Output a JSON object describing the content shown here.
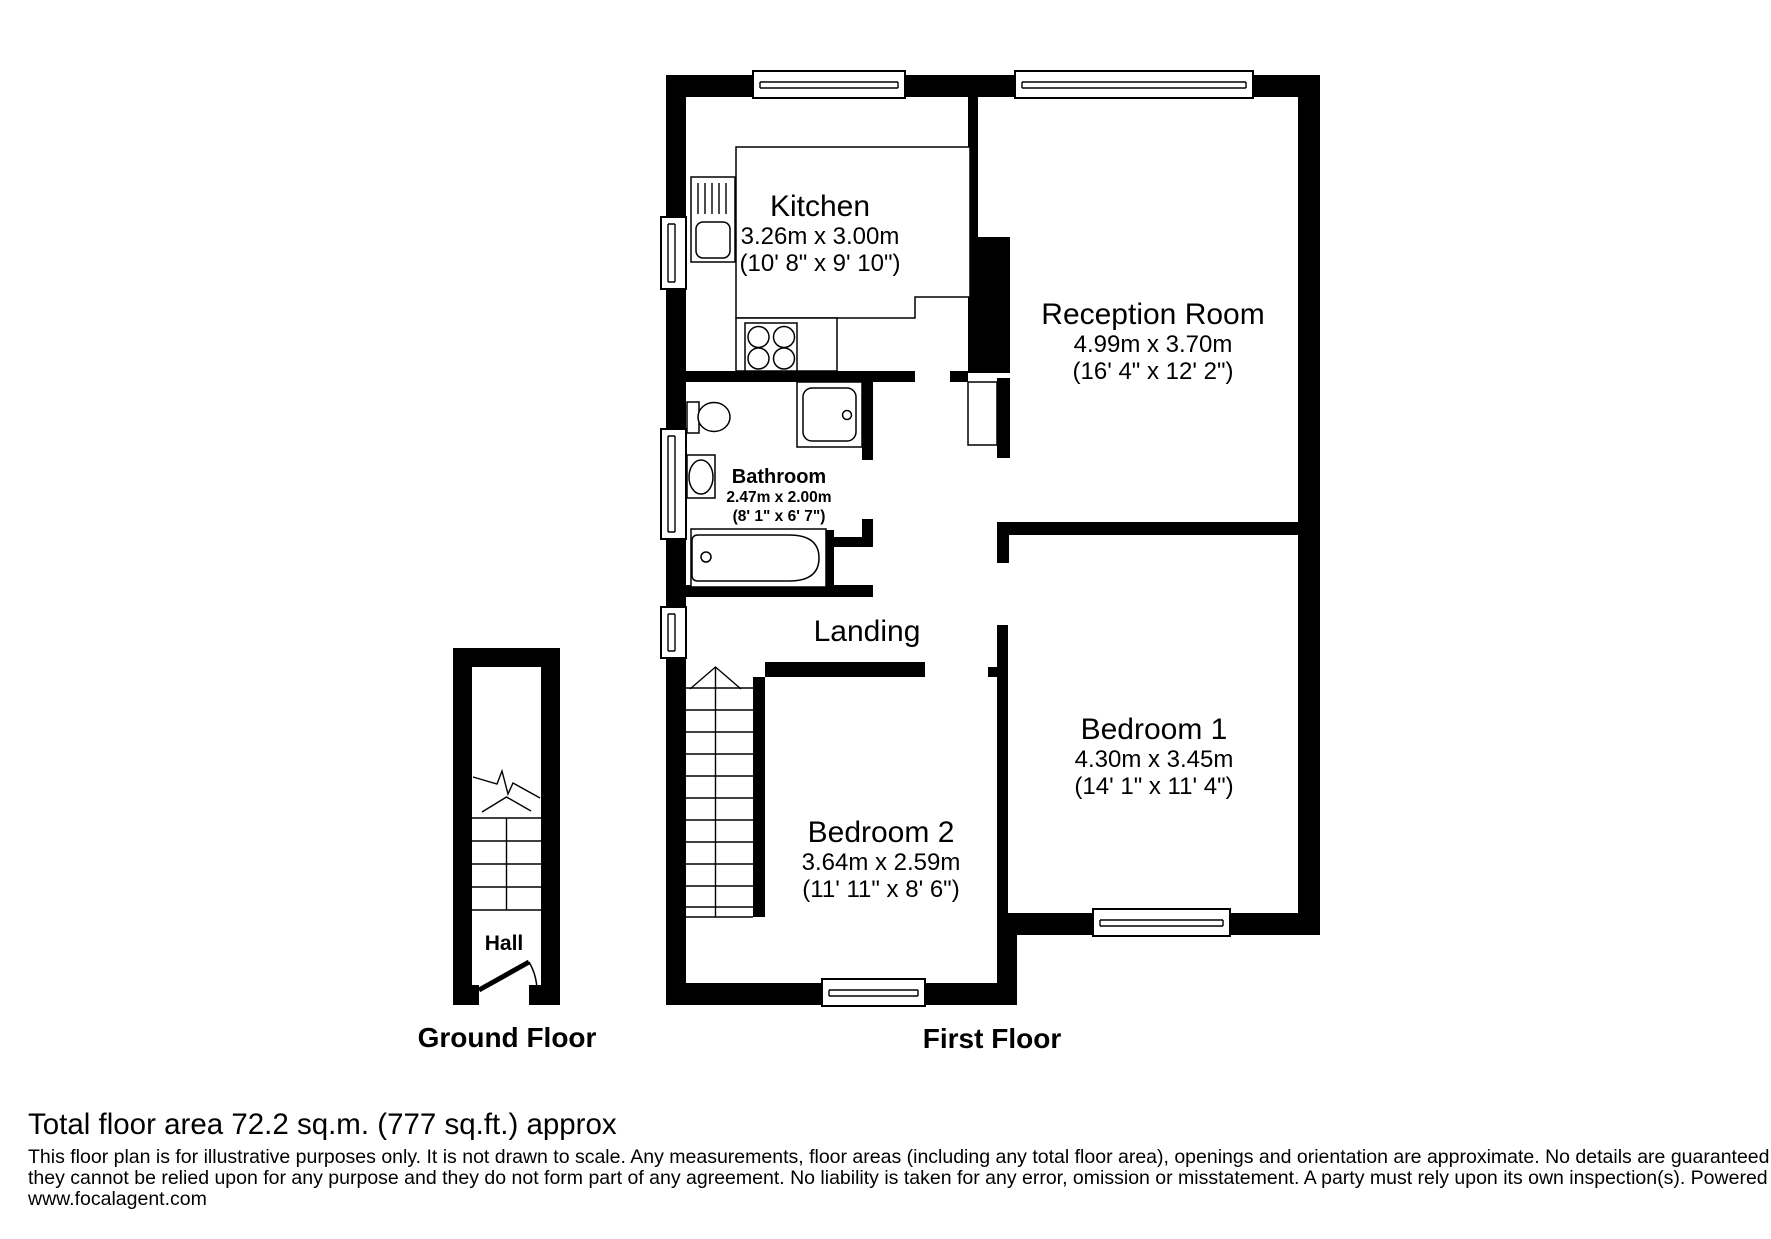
{
  "rooms": {
    "kitchen": {
      "name": "Kitchen",
      "metric": "3.26m x 3.00m",
      "imperial": "(10' 8\" x 9' 10\")"
    },
    "reception": {
      "name": "Reception Room",
      "metric": "4.99m x 3.70m",
      "imperial": "(16' 4\" x 12' 2\")"
    },
    "bathroom": {
      "name": "Bathroom",
      "metric": "2.47m x 2.00m",
      "imperial": "(8' 1\" x 6' 7\")"
    },
    "landing": {
      "name": "Landing"
    },
    "bedroom1": {
      "name": "Bedroom 1",
      "metric": "4.30m x 3.45m",
      "imperial": "(14' 1\" x 11' 4\")"
    },
    "bedroom2": {
      "name": "Bedroom 2",
      "metric": "3.64m x 2.59m",
      "imperial": "(11' 11\" x 8' 6\")"
    },
    "hall": {
      "name": "Hall"
    }
  },
  "floors": {
    "ground": "Ground Floor",
    "first": "First Floor"
  },
  "footer": {
    "total_area": "Total floor area 72.2 sq.m. (777 sq.ft.) approx",
    "disclaimer_line1": "This floor plan is for illustrative purposes only. It is not drawn to scale. Any measurements, floor areas (including any total floor area), openings and orientation are approximate. No details are guaranteed,",
    "disclaimer_line2": "they cannot be relied upon for any purpose and they do not form part of any agreement. No liability is taken for any error, omission or misstatement. A party must rely upon its own inspection(s). Powered by",
    "disclaimer_line3": "www.focalagent.com"
  },
  "fixtures": [
    "window",
    "kitchen-sink",
    "kitchen-counter",
    "kitchen-hob",
    "toilet",
    "wash-basin",
    "shower",
    "bath",
    "chimney-alcove",
    "staircase",
    "stairs-up-arrow",
    "entrance-door-swing"
  ],
  "colors": {
    "wall": "#000000",
    "background": "#ffffff"
  }
}
